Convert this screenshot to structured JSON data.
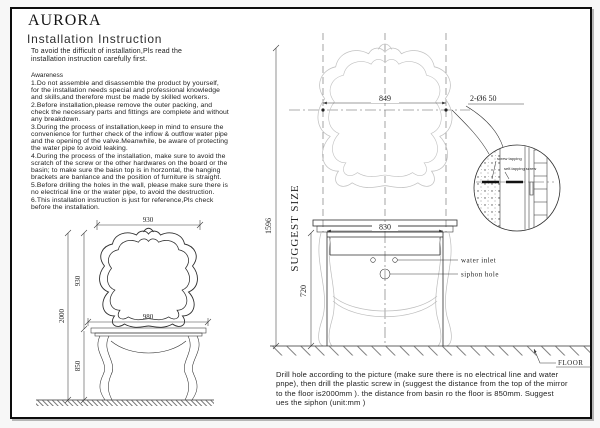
{
  "page": {
    "brand": "AURORA",
    "title": "Installation Instruction",
    "intro": "To avoid the difficult of installation,Pls read the installation instruction carefully first.",
    "awareness_label": "Awareness",
    "awareness_items": [
      "1.Do not assemble and disassemble the product by yourself, for the installation needs special and professional knowledge and skills,and therefore must be made by skilled workers.",
      "2.Before installation,please remove the outer packing, and check the necessary parts and fittings are complete and without any breakdown.",
      "3.During the process of installation,keep in mind to ensure the convenience for further check of the inflow & outflow water pipe and the opening of the valve.Meanwhile, be aware of protecting the water pipe to avoid leaking.",
      "4.During the process of the installation, make sure to avoid the scratch of the screw or the other hardwares on the board or the basin; to make sure the baisn top is in horzontal, the hanging brackets are banlance and the position of furniture is straight.",
      "5.Before drilling the holes in the wall, please make sure there is no electrical line or the water pipe, to avoid the destruction.",
      "6.This installation instruction is just for reference,Pls check before the installation."
    ],
    "bottom_note": "Drill hole according to the picture (make sure there is no electrical line and water pnpe), then drill the plastic screw in (suggest the distance from the top of the mirror to the floor is2000mm ). the distance from basin ro the floor is 850mm. Suggest ues the siphon (unit:mm )"
  },
  "left_drawing": {
    "mirror_width": "930",
    "mirror_height": "930",
    "overall_height": "2000",
    "cabinet_width": "980",
    "cabinet_height": "850"
  },
  "right_drawing": {
    "hole_distance": "849",
    "hole_spec": "2-Ø6  50",
    "overall_height": "1596",
    "suggest_label": "SUGGEST SIZE",
    "cabinet_width": "830",
    "cabinet_height": "720",
    "water_inlet_label": "water inlet",
    "siphon_label": "siphon hole",
    "floor_label": "FLOOR",
    "detail_labels": {
      "top": "screw tapping",
      "bottom": "self-tapping screw"
    }
  }
}
